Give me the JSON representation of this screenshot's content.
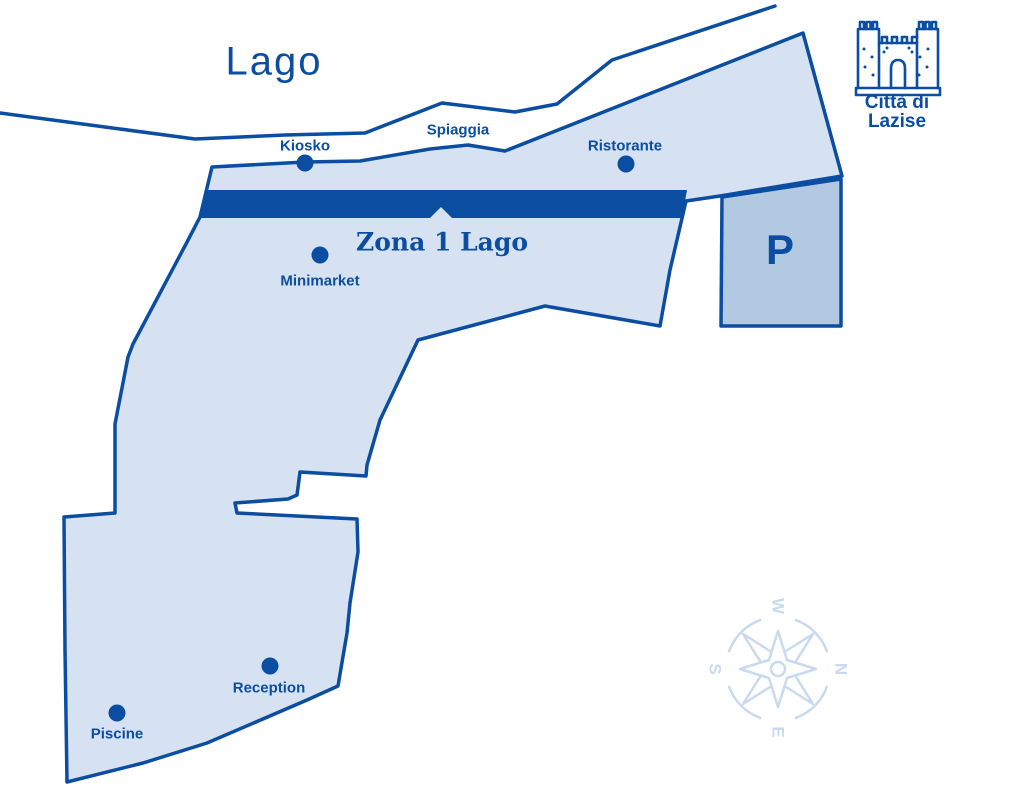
{
  "colors": {
    "dark_blue": "#0b4da1",
    "zone_fill": "#d6e2f1",
    "parking_fill": "#b3c9e2",
    "pale_blue": "#c9daee",
    "background": "#ffffff"
  },
  "map": {
    "lake_label": "Lago",
    "beach_label": "Spiaggia",
    "zone_label": "Zona 1 Lago",
    "parking_label": "P",
    "city_badge": {
      "line1": "Città di",
      "line2": "Lazise"
    },
    "pois": {
      "kiosko": "Kiosko",
      "ristorante": "Ristorante",
      "minimarket": "Minimarket",
      "reception": "Reception",
      "piscine": "Piscine"
    },
    "compass": {
      "north": "N",
      "east": "E",
      "south": "S",
      "west": "W"
    }
  }
}
